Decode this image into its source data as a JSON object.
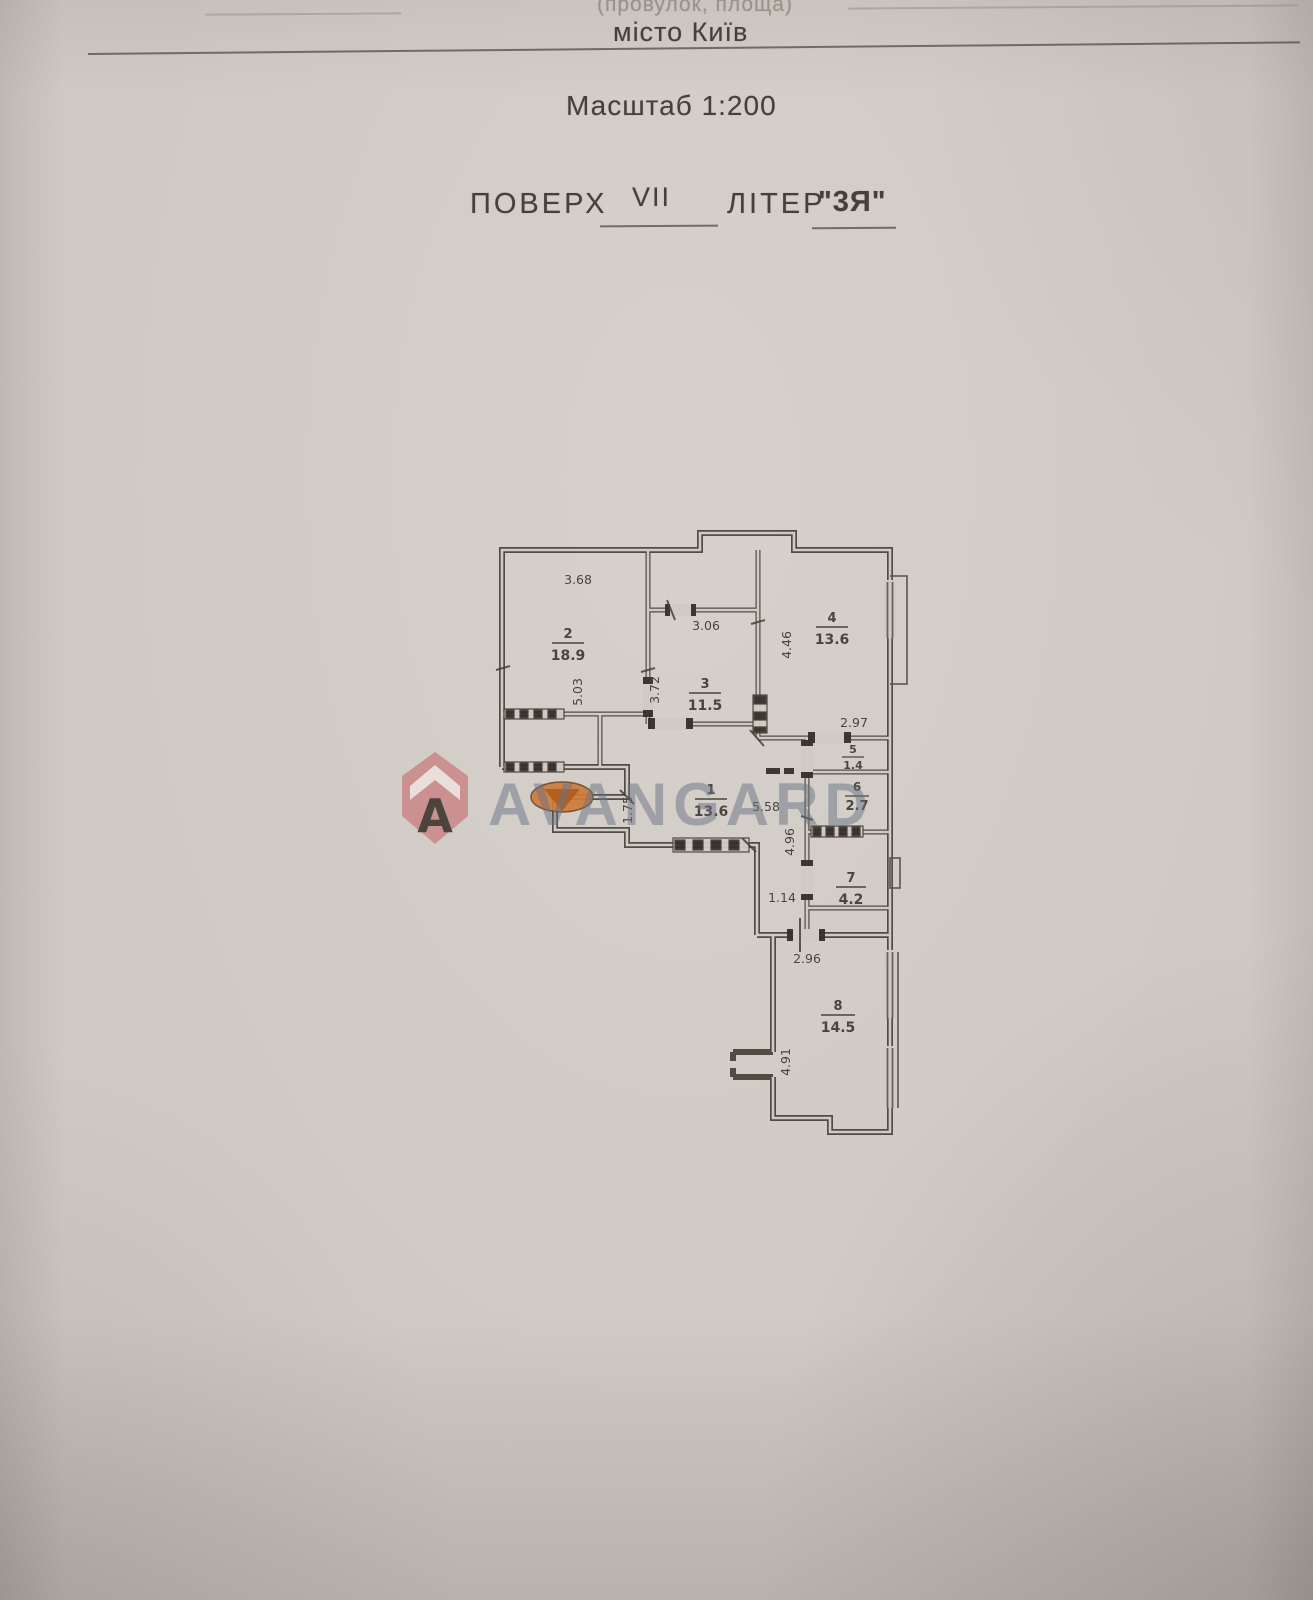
{
  "document": {
    "header": {
      "address_fragment": "(провулок, площа)",
      "city": "місто Київ",
      "scale": "Масштаб 1:200",
      "floor_label": "ПОВЕРХ",
      "floor_value": "VII",
      "letter_label": "ЛІТЕР",
      "letter_value": "\"3Я\""
    },
    "watermark": {
      "brand": "AVANGARD",
      "logo": "house-with-letter-A",
      "logo_letter": "A",
      "logo_color": "#c98484",
      "text_color": "#687283",
      "stamp_color": "#cd7c3a"
    },
    "plan": {
      "rooms": {
        "r1": {
          "number": "1",
          "area": "13.6"
        },
        "r2": {
          "number": "2",
          "area": "18.9"
        },
        "r3": {
          "number": "3",
          "area": "11.5"
        },
        "r4": {
          "number": "4",
          "area": "13.6"
        },
        "r5": {
          "number": "5",
          "area": "1.4"
        },
        "r6": {
          "number": "6",
          "area": "2.7"
        },
        "r7": {
          "number": "7",
          "area": "4.2"
        },
        "r8": {
          "number": "8",
          "area": "14.5"
        }
      },
      "dims": {
        "room2_width": "3.68",
        "room2_depth": "5.03",
        "room3_width": "3.06",
        "room3_depth": "3.72",
        "room4_depth": "4.46",
        "room4_width": "2.97",
        "hall_depth": "1.75",
        "hall_width": "5.58",
        "passage_depth": "4.96",
        "vestibule_width": "1.14",
        "room8_width": "2.96",
        "room8_depth": "4.91"
      }
    }
  }
}
